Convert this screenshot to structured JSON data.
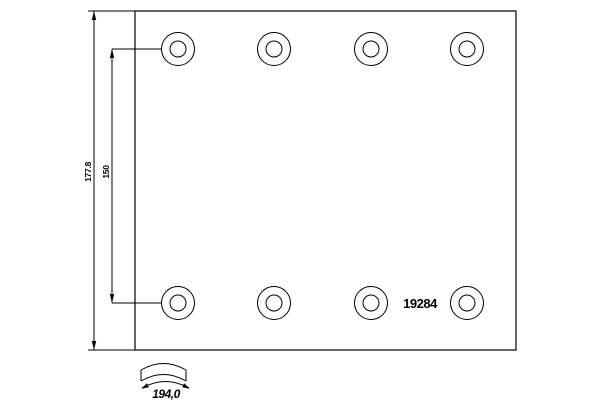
{
  "drawing": {
    "title": "brake-lining-technical-drawing",
    "part_number": "19284",
    "dimensions": {
      "overall_height_label": "177.8",
      "hole_row_spacing_label": "150",
      "arc_width_label": "194,0"
    },
    "holes": {
      "count": 8,
      "rows": 2,
      "columns": 4
    },
    "colors": {
      "line": "#000000",
      "background": "#ffffff"
    }
  }
}
